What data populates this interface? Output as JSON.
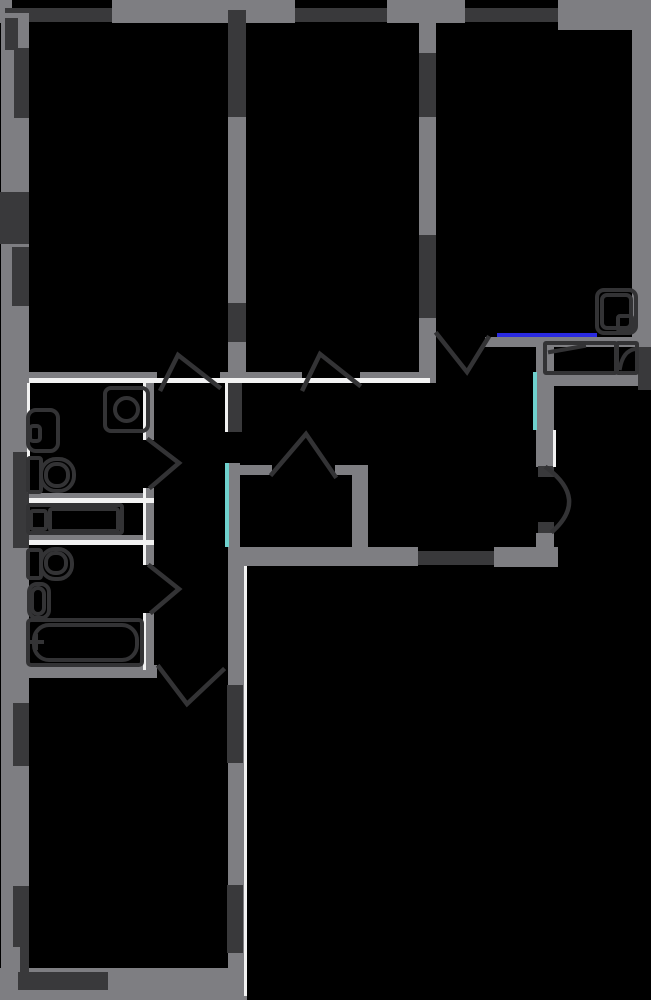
{
  "canvas": {
    "width": 651,
    "height": 1000,
    "background": "#000000"
  },
  "palette": {
    "gray": "#7e7e82",
    "dark": "#39393b",
    "white": "#f2f2f2",
    "blue": "#2a2ae0",
    "cyan": "#6fd1ce",
    "outline": "#333335"
  },
  "walls": [
    {
      "n": "top-wall-segment",
      "c": "gray",
      "r": [
        0,
        0,
        12,
        23
      ]
    },
    {
      "n": "top-wall-segment",
      "c": "gray",
      "r": [
        112,
        0,
        183,
        23
      ]
    },
    {
      "n": "top-wall-segment",
      "c": "gray",
      "r": [
        387,
        0,
        78,
        23
      ]
    },
    {
      "n": "top-wall-segment",
      "c": "gray",
      "r": [
        558,
        0,
        93,
        30
      ]
    },
    {
      "n": "top-window",
      "c": "dark",
      "r": [
        5,
        8,
        107,
        14
      ]
    },
    {
      "n": "top-window",
      "c": "dark",
      "r": [
        295,
        8,
        92,
        14
      ]
    },
    {
      "n": "top-window",
      "c": "dark",
      "r": [
        465,
        8,
        93,
        14
      ]
    },
    {
      "n": "left-wall",
      "c": "gray",
      "r": [
        1,
        13,
        28,
        955
      ]
    },
    {
      "n": "left-window",
      "c": "dark",
      "r": [
        5,
        18,
        13,
        32
      ]
    },
    {
      "n": "left-window",
      "c": "dark",
      "r": [
        14,
        48,
        15,
        70
      ]
    },
    {
      "n": "left-window",
      "c": "dark",
      "r": [
        0,
        192,
        29,
        52
      ]
    },
    {
      "n": "left-window",
      "c": "dark",
      "r": [
        12,
        247,
        17,
        59
      ]
    },
    {
      "n": "left-window",
      "c": "dark",
      "r": [
        13,
        452,
        16,
        96
      ]
    },
    {
      "n": "left-window",
      "c": "dark",
      "r": [
        13,
        703,
        16,
        63
      ]
    },
    {
      "n": "left-window",
      "c": "dark",
      "r": [
        13,
        886,
        16,
        61
      ]
    },
    {
      "n": "right-wall",
      "c": "gray",
      "r": [
        632,
        18,
        19,
        329
      ]
    },
    {
      "n": "right-wall-dark-segment",
      "c": "dark",
      "r": [
        638,
        347,
        13,
        43
      ]
    },
    {
      "n": "bottom-wall",
      "c": "gray",
      "r": [
        0,
        968,
        243,
        32
      ]
    },
    {
      "n": "bottom-window",
      "c": "dark",
      "r": [
        18,
        972,
        90,
        18
      ]
    },
    {
      "n": "bottom-corner-frame",
      "c": "dark",
      "r": [
        20,
        946,
        9,
        28
      ]
    },
    {
      "n": "bottom-room-right-wall",
      "c": "gray",
      "r": [
        228,
        566,
        19,
        434
      ]
    },
    {
      "n": "bottom-room-right-window",
      "c": "dark",
      "r": [
        227,
        685,
        16,
        78
      ]
    },
    {
      "n": "bottom-room-right-window",
      "c": "dark",
      "r": [
        227,
        885,
        16,
        68
      ]
    },
    {
      "n": "interior-wall-1-segment",
      "c": "dark",
      "r": [
        228,
        10,
        18,
        107
      ]
    },
    {
      "n": "interior-wall-1-segment",
      "c": "gray",
      "r": [
        228,
        117,
        18,
        186
      ]
    },
    {
      "n": "interior-wall-1-segment",
      "c": "dark",
      "r": [
        228,
        303,
        18,
        39
      ]
    },
    {
      "n": "interior-wall-1-segment",
      "c": "gray",
      "r": [
        228,
        342,
        18,
        41
      ]
    },
    {
      "n": "interior-wall-2-segment",
      "c": "gray",
      "r": [
        419,
        23,
        17,
        30
      ]
    },
    {
      "n": "interior-wall-2-segment",
      "c": "dark",
      "r": [
        419,
        53,
        17,
        64
      ]
    },
    {
      "n": "interior-wall-2-segment",
      "c": "gray",
      "r": [
        419,
        117,
        17,
        118
      ]
    },
    {
      "n": "interior-wall-2-segment",
      "c": "dark",
      "r": [
        419,
        235,
        17,
        83
      ]
    },
    {
      "n": "interior-wall-2-segment",
      "c": "gray",
      "r": [
        419,
        318,
        17,
        65
      ]
    },
    {
      "n": "hall-top-wall",
      "c": "gray",
      "r": [
        29,
        372,
        128,
        6
      ]
    },
    {
      "n": "hall-top-wall",
      "c": "gray",
      "r": [
        220,
        372,
        82,
        6
      ]
    },
    {
      "n": "hall-top-wall",
      "c": "gray",
      "r": [
        360,
        372,
        59,
        6
      ]
    },
    {
      "n": "hall-wall-stub",
      "c": "dark",
      "r": [
        228,
        383,
        14,
        49
      ]
    },
    {
      "n": "kitchen-top-wall",
      "c": "gray",
      "r": [
        485,
        337,
        166,
        10
      ]
    },
    {
      "n": "kitchen-left-wall",
      "c": "gray",
      "r": [
        536,
        347,
        18,
        120
      ]
    },
    {
      "n": "kitchen-left-wall",
      "c": "gray",
      "r": [
        536,
        533,
        18,
        34
      ]
    },
    {
      "n": "kitchen-door-jamb",
      "c": "dark",
      "r": [
        538,
        466,
        16,
        11
      ]
    },
    {
      "n": "kitchen-door-jamb",
      "c": "dark",
      "r": [
        538,
        522,
        16,
        11
      ]
    },
    {
      "n": "kitchen-bottom-wall",
      "c": "gray",
      "r": [
        228,
        547,
        190,
        19
      ]
    },
    {
      "n": "kitchen-bottom-wall-dark",
      "c": "dark",
      "r": [
        418,
        551,
        76,
        14
      ]
    },
    {
      "n": "kitchen-bottom-wall",
      "c": "gray",
      "r": [
        494,
        547,
        64,
        20
      ]
    },
    {
      "n": "counter-front-face",
      "c": "gray",
      "r": [
        545,
        372,
        93,
        14
      ]
    },
    {
      "n": "closet-left-wall",
      "c": "gray",
      "r": [
        228,
        463,
        12,
        84
      ]
    },
    {
      "n": "closet-top-wall",
      "c": "gray",
      "r": [
        240,
        465,
        32,
        10
      ]
    },
    {
      "n": "closet-top-wall",
      "c": "gray",
      "r": [
        335,
        465,
        33,
        10
      ]
    },
    {
      "n": "closet-right-wall",
      "c": "gray",
      "r": [
        352,
        465,
        16,
        82
      ]
    },
    {
      "n": "bathroom-right-wall",
      "c": "gray",
      "r": [
        146,
        383,
        8,
        57
      ]
    },
    {
      "n": "bathroom-right-wall",
      "c": "gray",
      "r": [
        146,
        488,
        8,
        77
      ]
    },
    {
      "n": "bathroom-right-wall",
      "c": "gray",
      "r": [
        146,
        613,
        8,
        57
      ]
    },
    {
      "n": "bathroom-divider-wall",
      "c": "gray",
      "r": [
        29,
        493,
        125,
        5
      ]
    },
    {
      "n": "bathroom-divider-wall",
      "c": "gray",
      "r": [
        29,
        535,
        125,
        5
      ]
    },
    {
      "n": "bathroom-bottom-wall",
      "c": "gray",
      "r": [
        29,
        665,
        128,
        13
      ]
    }
  ],
  "accents": [
    {
      "n": "threshold-line",
      "c": "white",
      "r": [
        29,
        378,
        401,
        5
      ]
    },
    {
      "n": "wall-edge-line",
      "c": "white",
      "r": [
        225,
        383,
        3,
        49
      ]
    },
    {
      "n": "wall-edge-line",
      "c": "white",
      "r": [
        143,
        383,
        3,
        57
      ]
    },
    {
      "n": "wall-edge-line",
      "c": "white",
      "r": [
        143,
        488,
        3,
        77
      ]
    },
    {
      "n": "wall-edge-line",
      "c": "white",
      "r": [
        143,
        613,
        3,
        57
      ]
    },
    {
      "n": "wall-edge-line",
      "c": "white",
      "r": [
        29,
        498,
        125,
        5
      ]
    },
    {
      "n": "wall-edge-line",
      "c": "white",
      "r": [
        29,
        540,
        125,
        5
      ]
    },
    {
      "n": "wall-edge-line",
      "c": "white",
      "r": [
        27,
        383,
        3,
        110
      ]
    },
    {
      "n": "wall-edge-line",
      "c": "white",
      "r": [
        244,
        566,
        3,
        430
      ]
    },
    {
      "n": "wall-edge-line",
      "c": "white",
      "r": [
        553,
        430,
        3,
        37
      ]
    },
    {
      "n": "window-glass-line",
      "c": "blue",
      "r": [
        497,
        333,
        100,
        4
      ]
    },
    {
      "n": "glass-partition-line",
      "c": "cyan",
      "r": [
        225,
        463,
        4,
        84
      ]
    },
    {
      "n": "glass-partition-line",
      "c": "cyan",
      "r": [
        533,
        372,
        4,
        58
      ]
    }
  ],
  "doors": [
    {
      "n": "door-swing-top-left-room",
      "pts": [
        [
          161,
          389
        ],
        [
          178,
          355
        ],
        [
          219,
          387
        ]
      ]
    },
    {
      "n": "door-swing-middle-room",
      "pts": [
        [
          303,
          389
        ],
        [
          320,
          354
        ],
        [
          359,
          385
        ]
      ]
    },
    {
      "n": "door-swing-top-right-room",
      "pts": [
        [
          437,
          334
        ],
        [
          467,
          372
        ],
        [
          488,
          338
        ]
      ]
    },
    {
      "n": "door-swing-bathroom-1",
      "pts": [
        [
          149,
          440
        ],
        [
          179,
          463
        ],
        [
          151,
          487
        ]
      ]
    },
    {
      "n": "door-swing-bathroom-2",
      "pts": [
        [
          150,
          566
        ],
        [
          179,
          589
        ],
        [
          152,
          612
        ]
      ]
    },
    {
      "n": "door-swing-bottom-room",
      "pts": [
        [
          159,
          667
        ],
        [
          187,
          704
        ],
        [
          223,
          670
        ]
      ]
    },
    {
      "n": "door-swing-closet",
      "pts": [
        [
          272,
          474
        ],
        [
          306,
          434
        ],
        [
          335,
          476
        ]
      ]
    },
    {
      "n": "door-swing-kitchen",
      "path": "M 547 468 Q 588 499 553 531"
    }
  ],
  "fixtures": [
    {
      "n": "washing-machine",
      "shapes": [
        {
          "k": "rect",
          "r": [
            105,
            388,
            43,
            43
          ],
          "rx": 6
        },
        {
          "k": "circle",
          "c": [
            126.5,
            409.5,
            11.5
          ]
        }
      ]
    },
    {
      "n": "washbasin-1",
      "shapes": [
        {
          "k": "rect",
          "r": [
            28,
            410,
            30,
            41
          ],
          "rx": 8
        },
        {
          "k": "rect",
          "r": [
            30,
            426,
            10,
            15
          ],
          "rx": 3
        }
      ]
    },
    {
      "n": "toilet-1",
      "shapes": [
        {
          "k": "rect",
          "r": [
            28,
            458,
            13,
            34
          ],
          "rx": 2
        },
        {
          "k": "rect",
          "r": [
            41,
            459,
            33,
            32
          ],
          "rx": 15
        },
        {
          "k": "rect",
          "r": [
            46,
            464,
            22,
            22
          ],
          "rx": 10
        }
      ]
    },
    {
      "n": "vanity-counter",
      "shapes": [
        {
          "k": "rect",
          "r": [
            28,
            505,
            94,
            28
          ],
          "rx": 2
        },
        {
          "k": "rect",
          "r": [
            31,
            511,
            15,
            18
          ],
          "rx": 2
        },
        {
          "k": "rect",
          "r": [
            50,
            509,
            68,
            22
          ],
          "rx": 2
        }
      ]
    },
    {
      "n": "toilet-2",
      "shapes": [
        {
          "k": "rect",
          "r": [
            28,
            550,
            13,
            28
          ],
          "rx": 2
        },
        {
          "k": "rect",
          "r": [
            41,
            549,
            31,
            30
          ],
          "rx": 14
        },
        {
          "k": "rect",
          "r": [
            46,
            553,
            20,
            20
          ],
          "rx": 9
        }
      ]
    },
    {
      "n": "washbasin-2",
      "shapes": [
        {
          "k": "rect",
          "r": [
            29,
            584,
            20,
            34
          ],
          "rx": 8
        },
        {
          "k": "rect",
          "r": [
            32,
            588,
            12,
            26
          ],
          "rx": 6
        }
      ]
    },
    {
      "n": "bathtub",
      "shapes": [
        {
          "k": "rect",
          "r": [
            28,
            620,
            114,
            45
          ],
          "rx": 3
        },
        {
          "k": "rect",
          "r": [
            34,
            625,
            103,
            35
          ],
          "rx": 15
        },
        {
          "k": "line",
          "p": [
            30,
            642,
            42,
            642
          ]
        },
        {
          "k": "line",
          "p": [
            36,
            636,
            36,
            648
          ]
        }
      ]
    },
    {
      "n": "corner-washbasin",
      "shapes": [
        {
          "k": "rect",
          "r": [
            597,
            290,
            39,
            43
          ],
          "rx": 7
        },
        {
          "k": "rect",
          "r": [
            602,
            295,
            29,
            33
          ],
          "rx": 5
        },
        {
          "k": "rect",
          "r": [
            618,
            316,
            14,
            15
          ],
          "rx": 2
        }
      ]
    },
    {
      "n": "kitchen-counter",
      "shapes": [
        {
          "k": "rect",
          "r": [
            545,
            343,
            71,
            30
          ],
          "rx": 1
        },
        {
          "k": "line",
          "p": [
            550,
            352,
            584,
            346
          ]
        }
      ]
    },
    {
      "n": "kitchen-sink",
      "shapes": [
        {
          "k": "rect",
          "r": [
            617,
            343,
            20,
            30
          ],
          "rx": 1
        },
        {
          "k": "path",
          "d": "M 620 368 Q 623 351 635 349"
        }
      ]
    }
  ]
}
